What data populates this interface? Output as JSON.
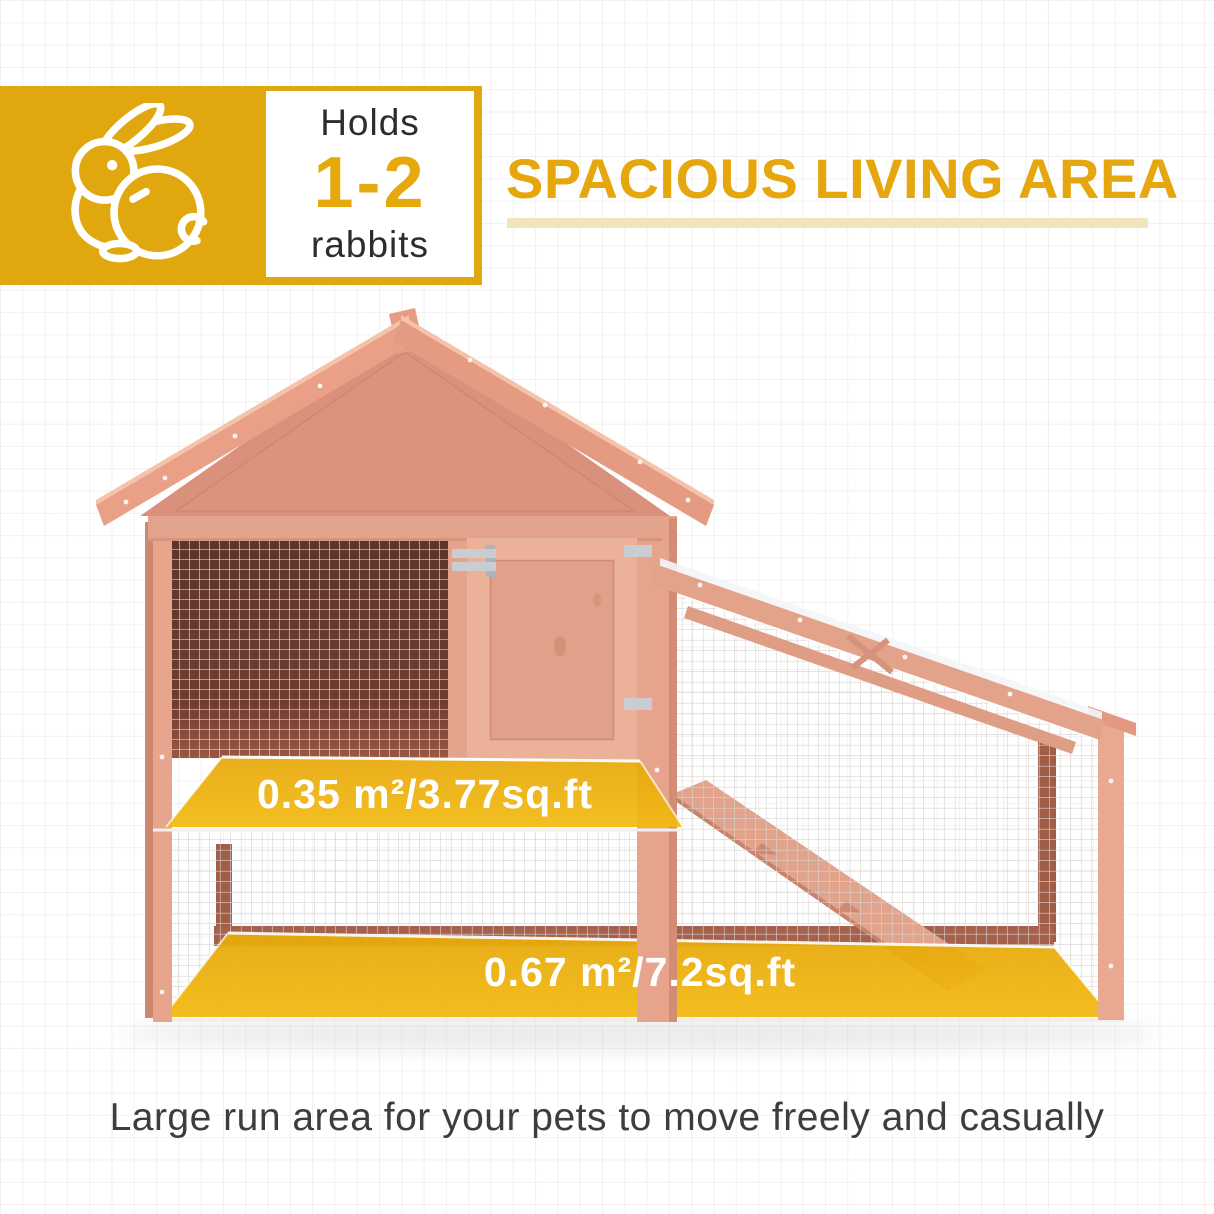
{
  "badge": {
    "line1": "Holds",
    "value": "1-2",
    "line2": "rabbits",
    "icon": "rabbit-icon"
  },
  "heading": {
    "title": "SPACIOUS LIVING AREA"
  },
  "hutch": {
    "upper_area_label": "0.35 m²/3.77sq.ft",
    "run_area_label": "0.67 m²/7.2sq.ft"
  },
  "caption": {
    "text": "Large run area for your pets to move freely and casually"
  },
  "colors": {
    "brand_yellow": "#E1A70F",
    "value_yellow": "#E6A90C",
    "heading_yellow": "#E5A60E",
    "underline_pale_yellow": "#F3E5BB",
    "area_highlight_yellow": "#EBAC0C",
    "wood_main": "#DD947C",
    "wood_light": "#E9A086",
    "window_interior_dark": "#5E352C",
    "mesh_gray": "#D8D4D0",
    "text_dark": "#2D2D2D",
    "caption_gray": "#3D3D3D",
    "label_text_white": "#FFFFFF"
  }
}
